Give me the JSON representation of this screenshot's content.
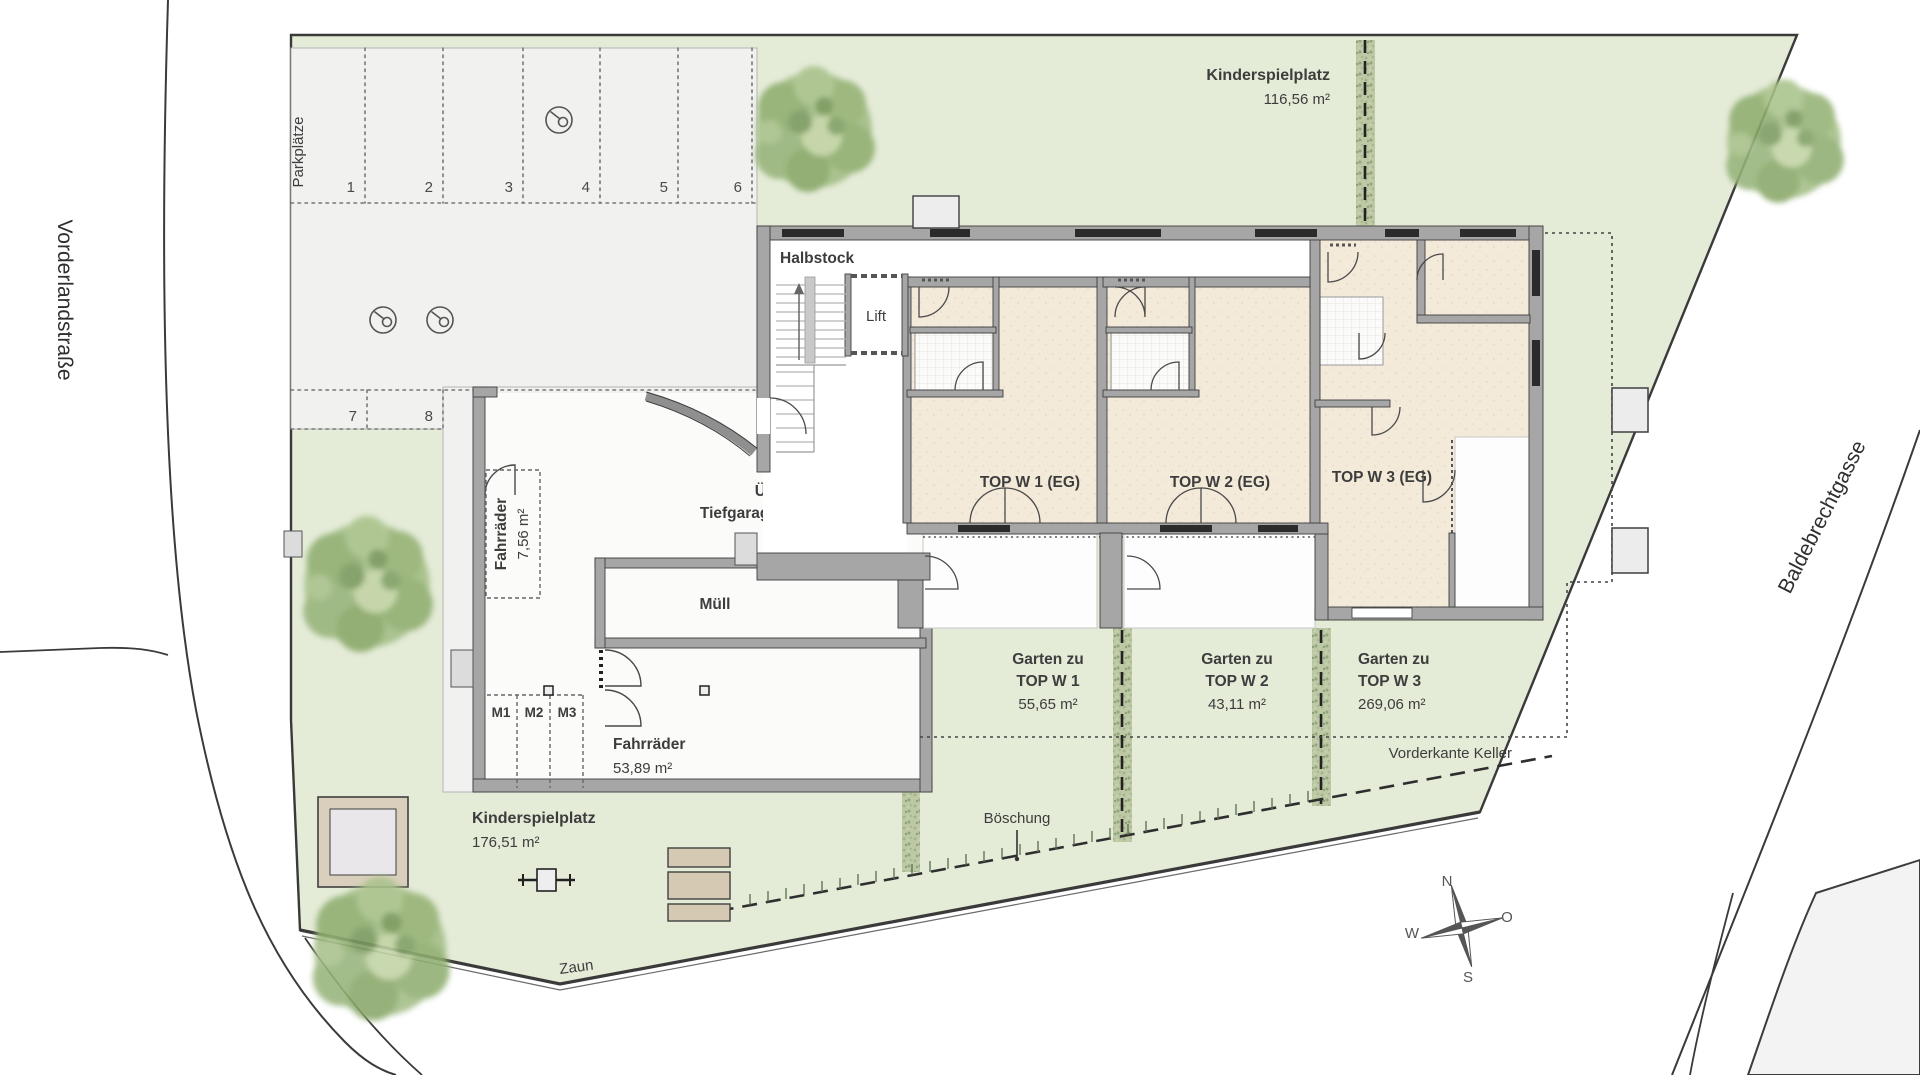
{
  "streets": {
    "left": "Vorderlandstraße",
    "right": "Baldebrechtgasse"
  },
  "parking": {
    "label": "Parkplätze",
    "stall_numbers": [
      "1",
      "2",
      "3",
      "4",
      "5",
      "6",
      "7",
      "8"
    ],
    "moped": [
      "M1",
      "M2",
      "M3"
    ]
  },
  "building": {
    "half_level": "Halbstock",
    "lift": "Lift",
    "units": [
      "TOP W 1 (EG)",
      "TOP W 2 (EG)",
      "TOP W 3 (EG)"
    ]
  },
  "facilities": {
    "bike_small": {
      "name": "Fahrräder",
      "area": "7,56 m²"
    },
    "bike_large": {
      "name": "Fahrräder",
      "area": "53,89 m²"
    },
    "waste": {
      "name": "Müll"
    },
    "ramp": {
      "line1": "Überdachte",
      "line2": "Tiefgaragenabfahrt",
      "gate": "TG-Tor"
    }
  },
  "playgrounds": {
    "north": {
      "name": "Kinderspielplatz",
      "area": "116,56 m²"
    },
    "south": {
      "name": "Kinderspielplatz",
      "area": "176,51 m²"
    }
  },
  "gardens": [
    {
      "line1": "Garten zu",
      "line2": "TOP W 1",
      "area": "55,65 m²"
    },
    {
      "line1": "Garten zu",
      "line2": "TOP W 2",
      "area": "43,11 m²"
    },
    {
      "line1": "Garten zu",
      "line2": "TOP W 3",
      "area": "269,06 m²"
    }
  ],
  "annotations": {
    "basement_edge": "Vorderkante Keller",
    "slope": "Böschung",
    "fence": "Zaun"
  },
  "compass": {
    "north": "N",
    "east": "O",
    "south": "S",
    "west": "W"
  },
  "colors": {
    "lawn": "#e4ebd7",
    "paving": "#f1f1ef",
    "wall": "#a6a6a6",
    "floor": "#f3ead9",
    "hedge": "#bcc9a4",
    "tree": "#9bb77f",
    "text": "#3d3d3d"
  }
}
